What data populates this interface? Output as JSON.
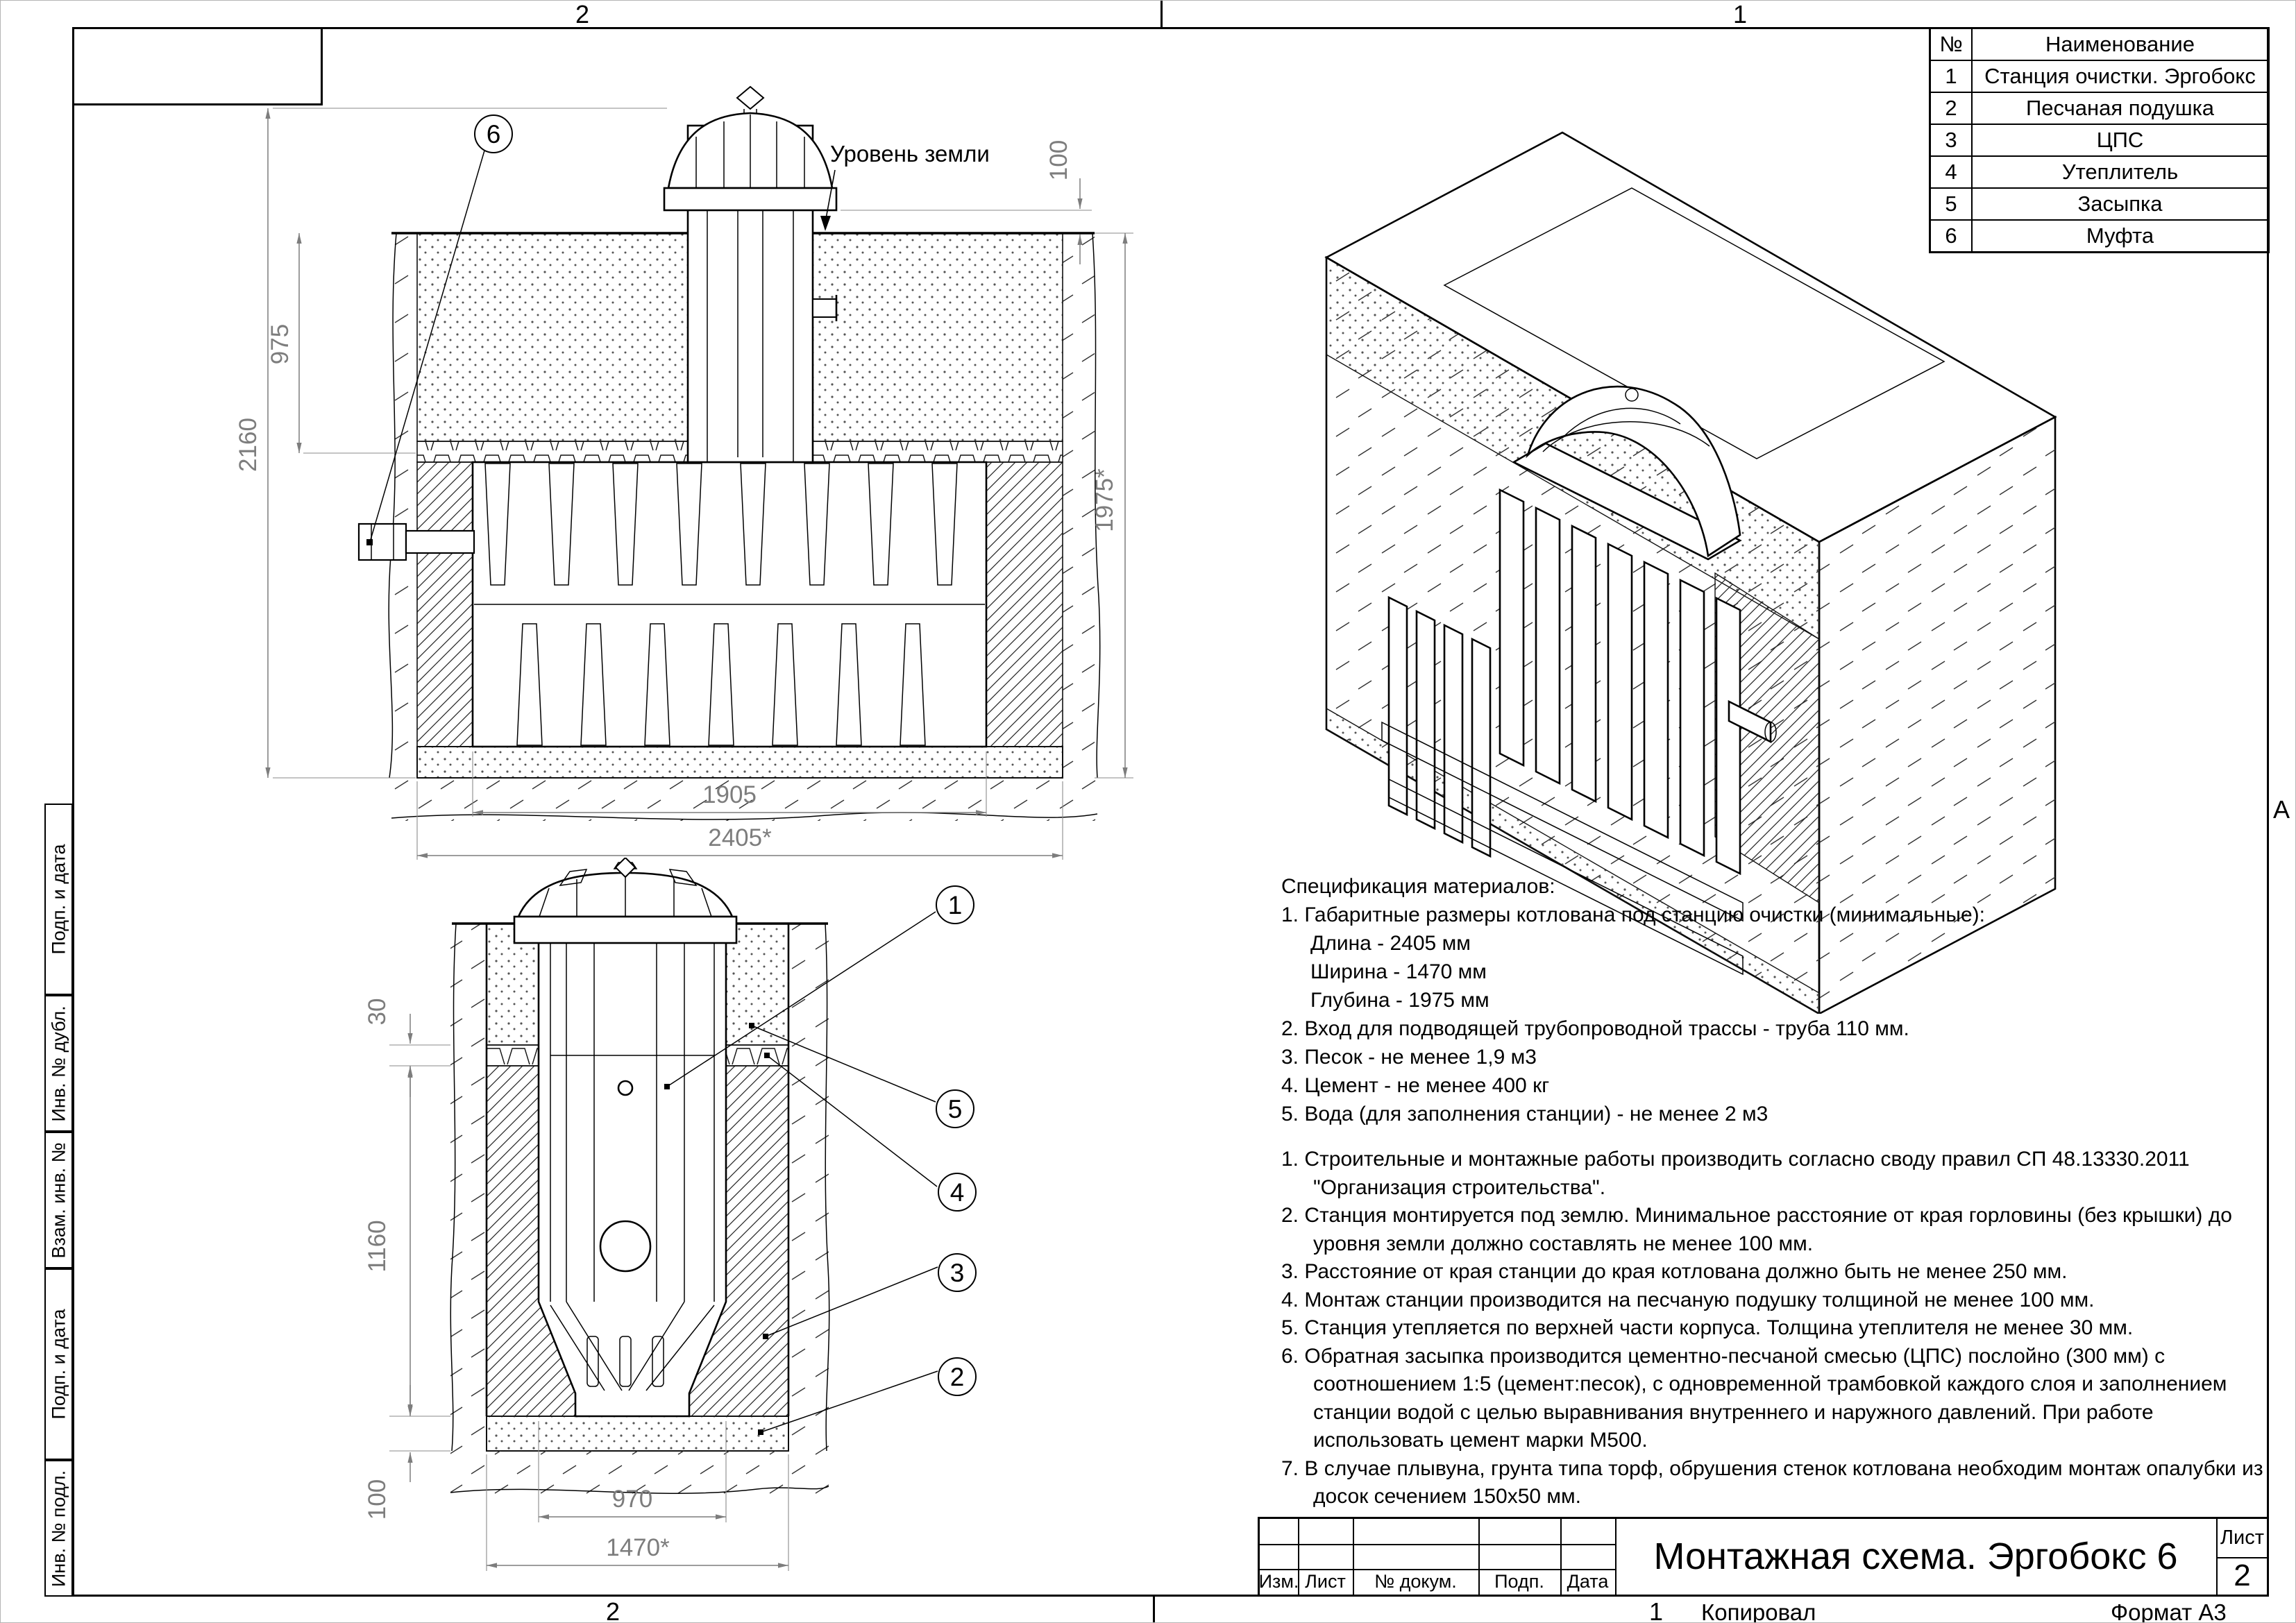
{
  "sheet": {
    "zones": {
      "top": [
        "2",
        "1"
      ],
      "bottom": [
        "2",
        "1"
      ],
      "right_letter": "А"
    },
    "side_column_labels": [
      "Подп. и дата",
      "Инв. № дубл.",
      "Взам. инв. №",
      "Подп. и дата",
      "Инв. № подл."
    ]
  },
  "parts_table": {
    "col_no": "№",
    "col_name": "Наименование",
    "rows": [
      {
        "no": "1",
        "name": "Станция очистки. Эргобокс"
      },
      {
        "no": "2",
        "name": "Песчаная подушка"
      },
      {
        "no": "3",
        "name": "ЦПС"
      },
      {
        "no": "4",
        "name": "Утеплитель"
      },
      {
        "no": "5",
        "name": "Засыпка"
      },
      {
        "no": "6",
        "name": "Муфта"
      }
    ]
  },
  "side_section": {
    "ground_label": "Уровень земли",
    "callout": "6",
    "dim_height_total": "2160",
    "dim_depth_top": "975",
    "dim_cover": "100",
    "dim_pit_depth": "1975*",
    "dim_station_length": "1905",
    "dim_pit_length": "2405*"
  },
  "front_section": {
    "callouts": [
      "1",
      "5",
      "4",
      "3",
      "2"
    ],
    "dim_insulation": "30",
    "dim_body_depth": "1160",
    "dim_cushion": "100",
    "dim_station_width": "970",
    "dim_pit_width": "1470*"
  },
  "spec": {
    "title": "Спецификация материалов:",
    "lines": [
      "1. Габаритные размеры котлована под станцию очистки (минимальные):",
      "Длина - 2405 мм",
      "Ширина - 1470 мм",
      "Глубина - 1975 мм",
      "2. Вход для подводящей трубопроводной трассы - труба 110 мм.",
      "3. Песок - не менее 1,9 м3",
      "4. Цемент - не менее 400 кг",
      "5. Вода (для заполнения станции) - не менее 2 м3"
    ]
  },
  "notes": {
    "items": [
      "1. Строительные и монтажные работы производить согласно своду правил СП 48.13330.2011 \"Организация строительства\".",
      "2. Станция монтируется под землю. Минимальное расстояние от края горловины (без крышки) до уровня земли должно составлять не менее 100 мм.",
      "3. Расстояние от края станции до края котлована должно быть не менее 250 мм.",
      "4. Монтаж станции производится на песчаную подушку толщиной не менее 100 мм.",
      "5. Станция утепляется по верхней части корпуса. Толщина утеплителя не менее 30 мм.",
      "6. Обратная засыпка производится цементно-песчаной смесью (ЦПС) послойно (300 мм) с соотношением 1:5 (цемент:песок), с одновременной трамбовкой каждого слоя и заполнением станции водой с целью выравнивания внутреннего и наружного давлений. При работе использовать цемент марки М500.",
      "7. В случае плывуна, грунта типа торф, обрушения стенок котлована необходим монтаж опалубки из досок сечением 150x50 мм."
    ]
  },
  "title_block": {
    "title": "Монтажная схема. Эргобокс 6",
    "col_izm": "Изм.",
    "col_list": "Лист",
    "col_doc": "№ докум.",
    "col_sign": "Подп.",
    "col_date": "Дата",
    "sheet_word": "Лист",
    "sheet_num": "2",
    "footer_zone": "1",
    "footer_copy": "Копировал",
    "footer_format": "Формат А3"
  }
}
